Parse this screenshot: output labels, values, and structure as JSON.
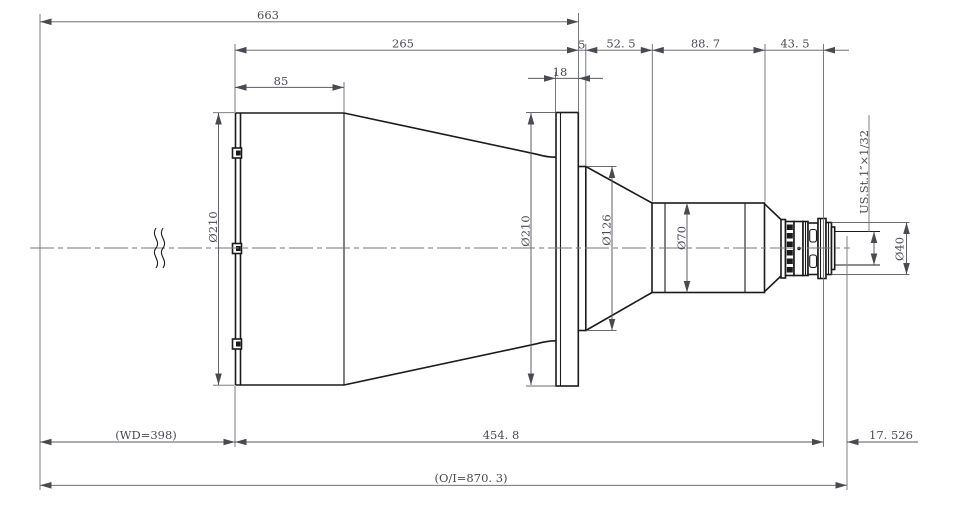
{
  "drawing": {
    "type": "lens mechanical outline drawing",
    "dims": {
      "top_overall": "663",
      "front_to_flange": "265",
      "hood_front": "85",
      "flange_thickness": "18",
      "ring_width": "5",
      "taper_length": "52. 5",
      "barrel_length": "88. 7",
      "rear_length": "43. 5",
      "working_distance": "(WD=398)",
      "flange_to_image": "454. 8",
      "back_focal": "17. 526",
      "object_image": "(O/I=870. 3)"
    },
    "diameters": {
      "front": "Ø210",
      "flange": "Ø210",
      "mid": "Ø126",
      "barrel": "Ø70",
      "rear": "Ø40"
    },
    "thread": {
      "spec": "US.St.1″×1/32"
    }
  }
}
